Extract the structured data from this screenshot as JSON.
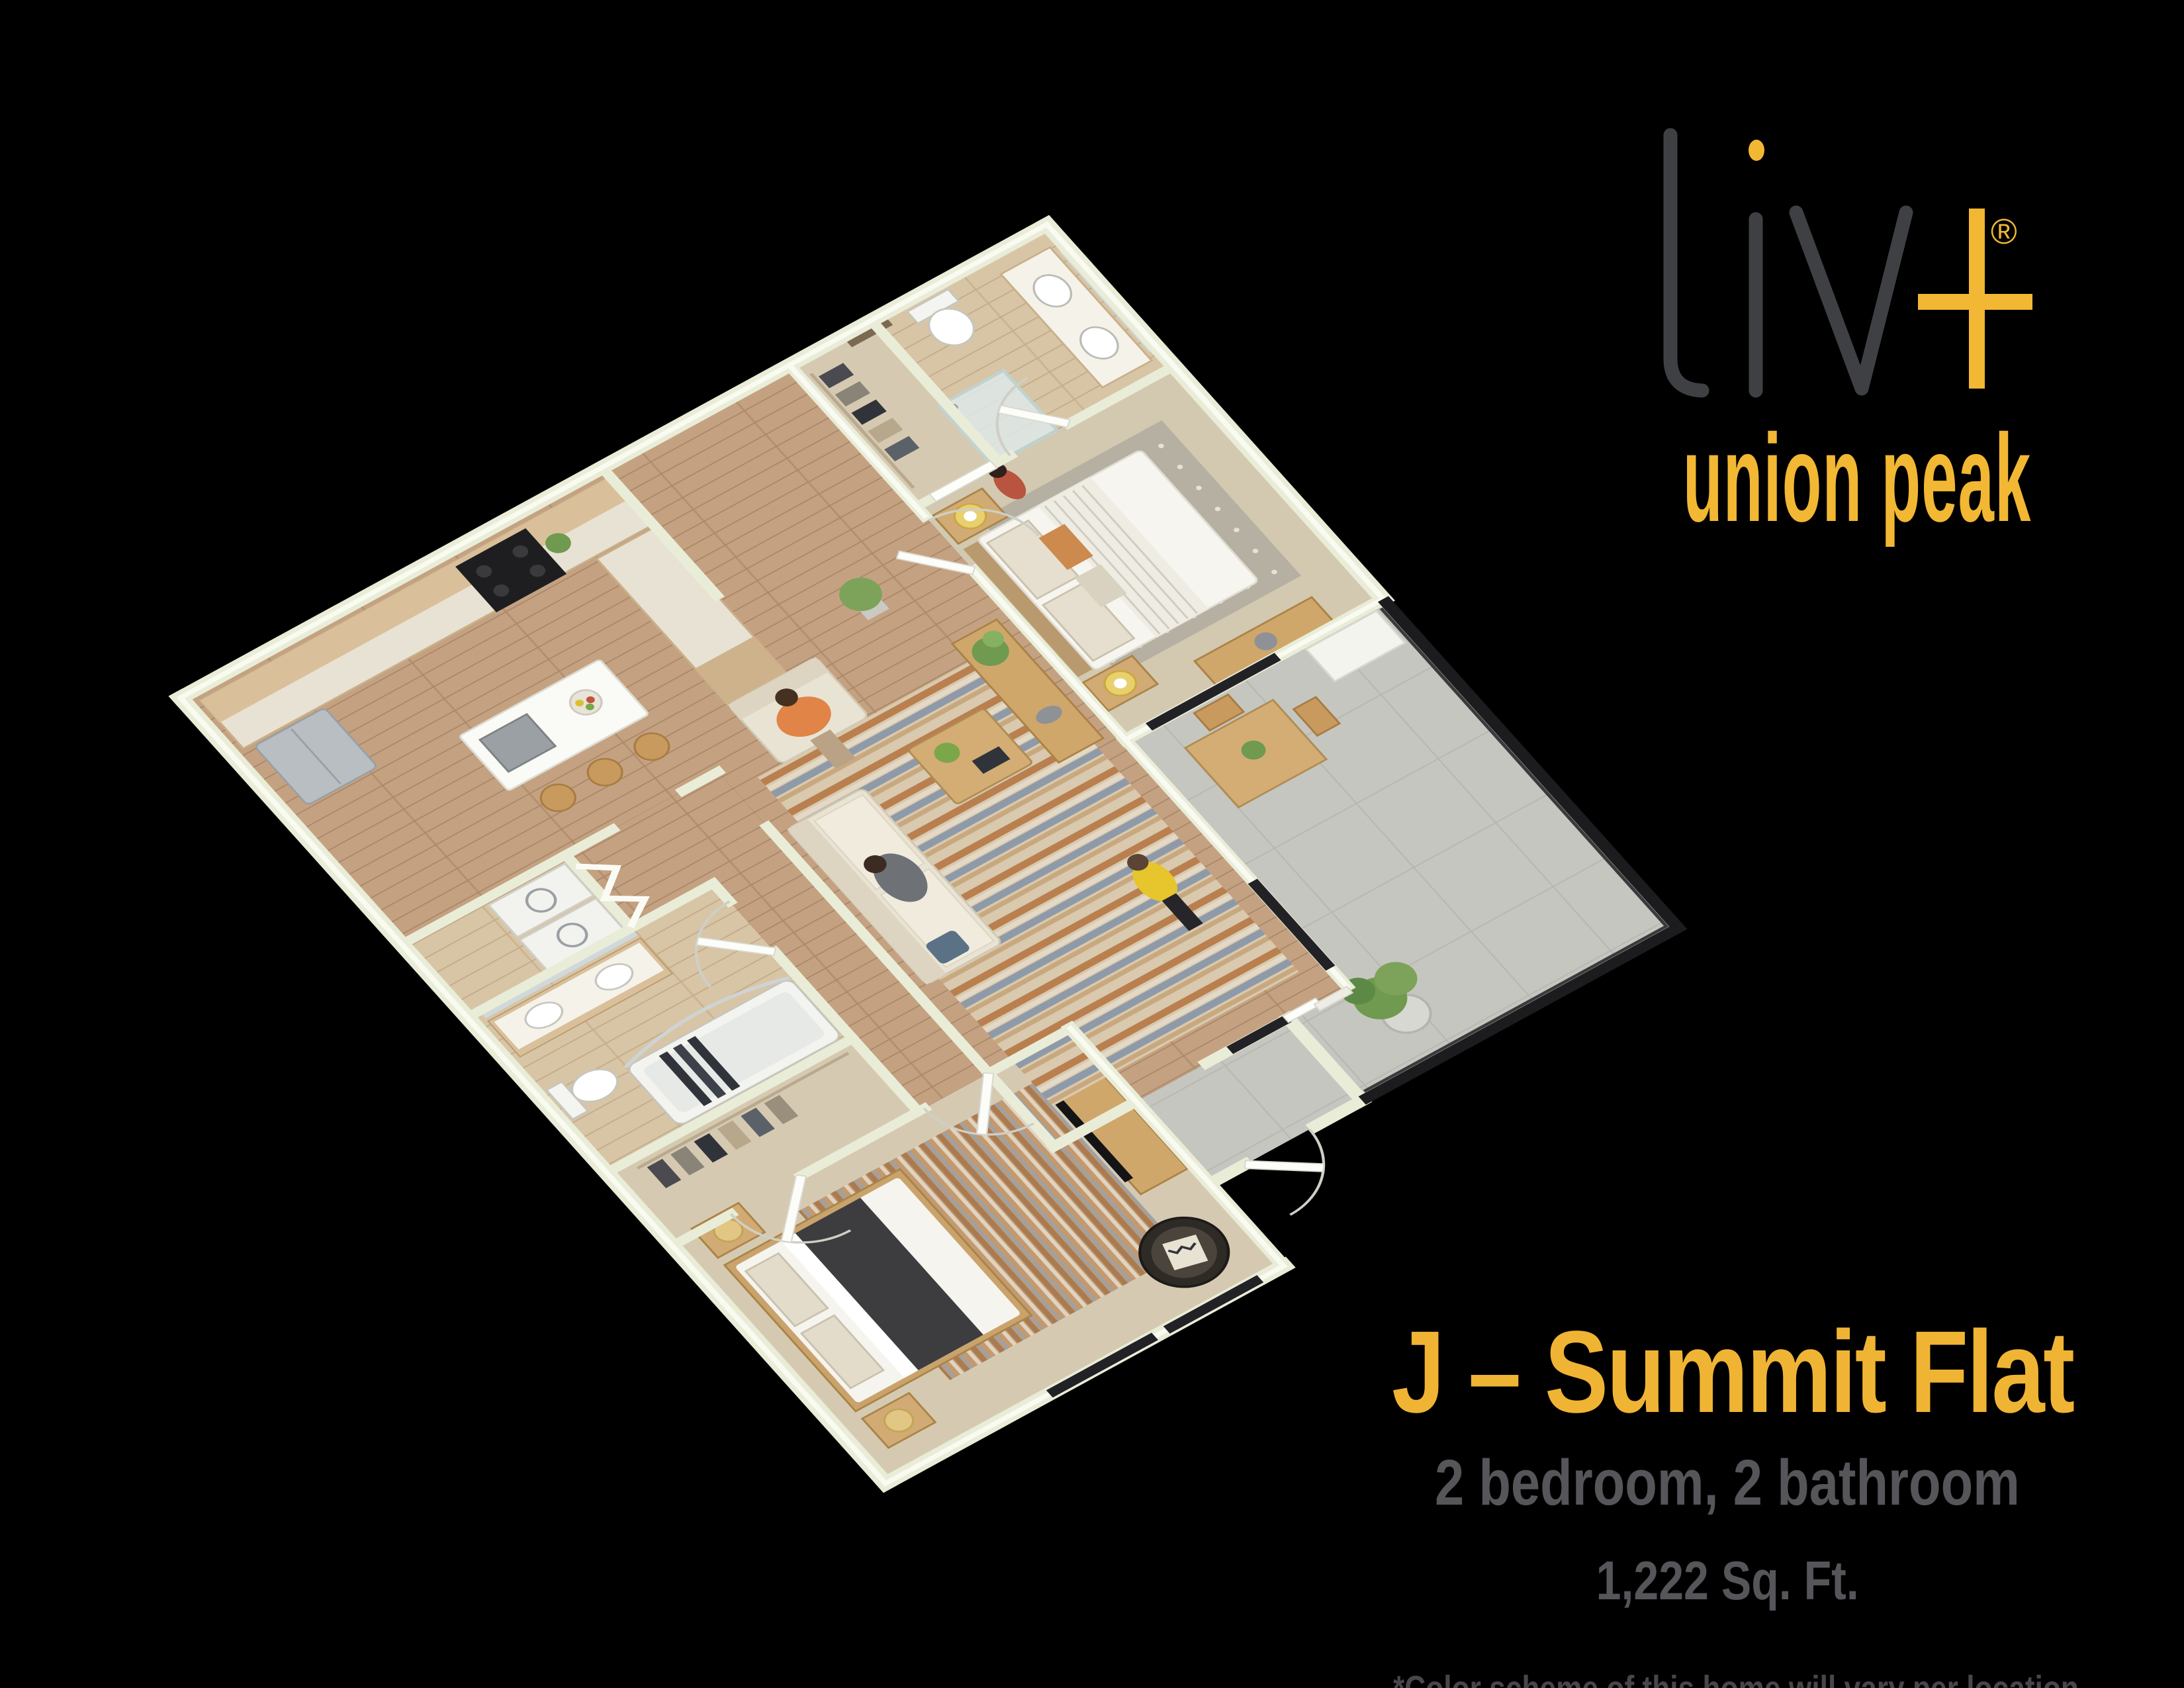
{
  "brand": {
    "name": "liv",
    "plus": "+",
    "registered": "®",
    "sub_brand": "union peak"
  },
  "floor_plan_title": {
    "name": "J – Summit Flat",
    "specs": "2 bedroom, 2 bathroom",
    "area": "1,222 Sq. Ft."
  },
  "disclaimer": {
    "line1": "*Color scheme of this home will vary per location.",
    "line2": "Please ask for more information."
  },
  "colors": {
    "background": "#000000",
    "accent_yellow": "#F2B733",
    "logo_gray": "#3F4043",
    "heading_gray": "#55555A",
    "disclaimer_gray": "#47474B",
    "wall": "#E9EDD8",
    "wall_core": "#FBFCF4",
    "wood_floor": "#C4A281",
    "light_wood_floor": "#D8C5A6",
    "carpet": "#D5CAB1",
    "concrete": "#C6C6C0",
    "railing_black": "#1C1C1E"
  }
}
